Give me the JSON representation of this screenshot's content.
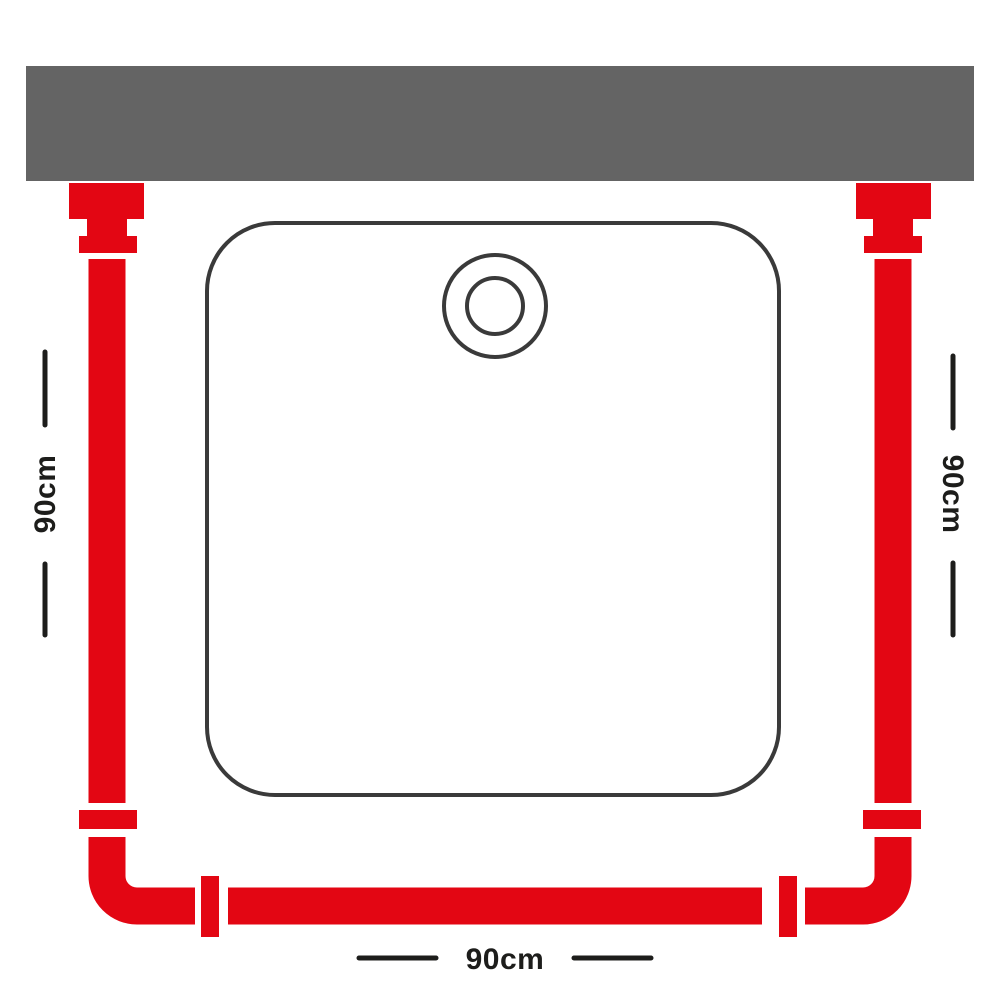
{
  "colors": {
    "rail_red": "#e30613",
    "wall_gray": "#646464",
    "outline_dark": "#3a3a3a",
    "label_text": "#1d1d1b",
    "page_bg": "#ffffff"
  },
  "diagram": {
    "kind": "shower-rail-dimension-diagram",
    "dimension_labels": {
      "left": "90cm",
      "right": "90cm",
      "bottom": "90cm"
    }
  }
}
